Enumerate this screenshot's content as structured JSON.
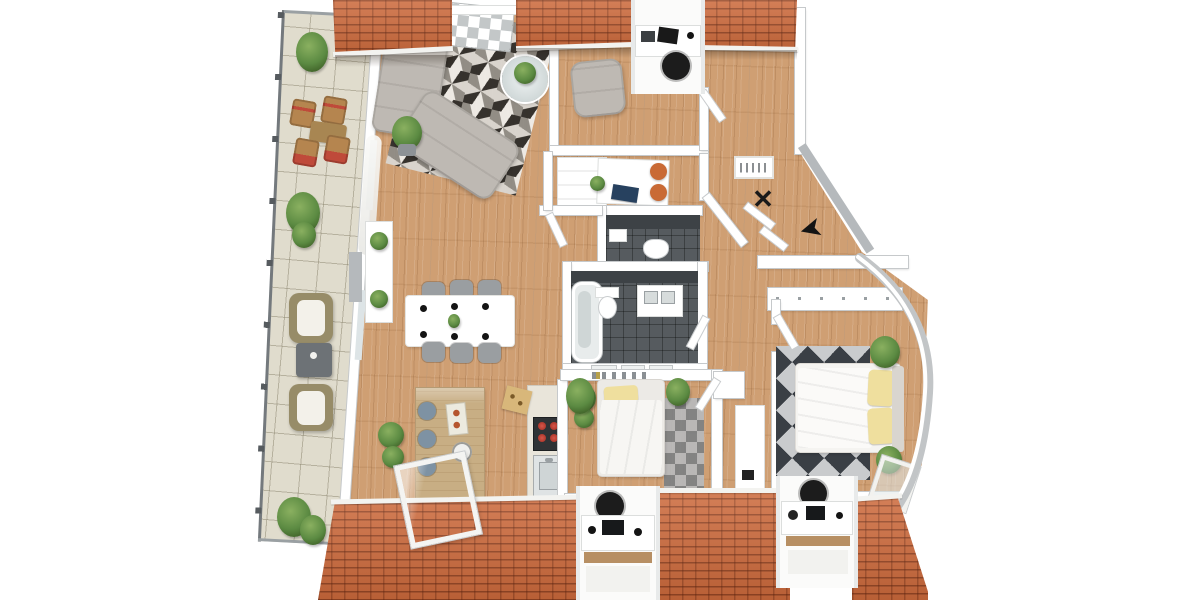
{
  "scene": {
    "type": "3d-floorplan-top-down-render",
    "subject": "attic apartment with wrap-around terrace, orange tiled roof and dormers"
  },
  "palette": {
    "roof": "#cd6a3c",
    "wood": "#cf9f73",
    "terrace": "#e0dccd",
    "wall_edge": "#c6c9cb",
    "wall_gray": "#b5b9bc",
    "bath_floor": "#565b5f",
    "bath_wall": "#3d4246",
    "sofa": "#beb9b3",
    "chair_gray": "#9a9ea1",
    "island": "#c8ae84",
    "stool": "#7e92a3",
    "accent_orange": "#c96a35",
    "pillow": "#efdf9e",
    "plant": "#5b8a42",
    "glass": "#b9c6c6",
    "blue": "#27415f",
    "burner": "#b03a2e",
    "wicker": "#978c68",
    "cushion": "#f3f1ea",
    "table_dark": "#6d7276",
    "wood_chair": "#b5854f",
    "rug_dark": "#2e2c29",
    "rug_mid": "#8f8c86",
    "rug_light": "#dad7d2",
    "mrug_dark": "#3a3f45",
    "mrug_light": "#c9cbcd",
    "black": "#1c1c1c"
  },
  "icons": {
    "north_arrow": "➤",
    "coat_rack": "✕"
  },
  "rooms": [
    {
      "name": "terrace",
      "furniture": [
        "glass-railing",
        "outdoor-dining-chairs",
        "outdoor-table",
        "wicker-lounge-chairs",
        "coffee-table",
        "potted-plants"
      ]
    },
    {
      "name": "living-room",
      "furniture": [
        "sectional-sofa",
        "geometric-rug",
        "round-coffee-table",
        "shelving-unit",
        "potted-plant",
        "sideboard"
      ]
    },
    {
      "name": "dining-area",
      "furniture": [
        "white-dining-table",
        "six-gray-chairs",
        "black-place-settings",
        "centerpiece-plant"
      ]
    },
    {
      "name": "kitchen",
      "furniture": [
        "island-counter",
        "bar-stools",
        "cooktop",
        "sink",
        "skylight-window",
        "potted-plants"
      ]
    },
    {
      "name": "office-nook",
      "furniture": [
        "dormer-desk",
        "office-chair",
        "armchair",
        "side-table",
        "orange-stools",
        "blue-book",
        "sideboard"
      ]
    },
    {
      "name": "entry-hall",
      "furniture": [
        "wall-picture",
        "coat-rack",
        "north-arrow-marker"
      ]
    },
    {
      "name": "wc",
      "furniture": [
        "toilet",
        "hand-basin"
      ]
    },
    {
      "name": "bathroom",
      "furniture": [
        "bathtub",
        "toilet",
        "double-vanity",
        "windows"
      ]
    },
    {
      "name": "small-bedroom",
      "furniture": [
        "single-bed",
        "yellow-pillow",
        "patch-rug",
        "wall-shelf",
        "closet",
        "dormer-desk",
        "office-chair",
        "plants"
      ]
    },
    {
      "name": "master-bedroom",
      "furniture": [
        "double-bed",
        "yellow-pillows",
        "triangle-rug",
        "wardrobe",
        "dormer-desk",
        "office-chair",
        "tilted-window",
        "plants"
      ]
    }
  ]
}
